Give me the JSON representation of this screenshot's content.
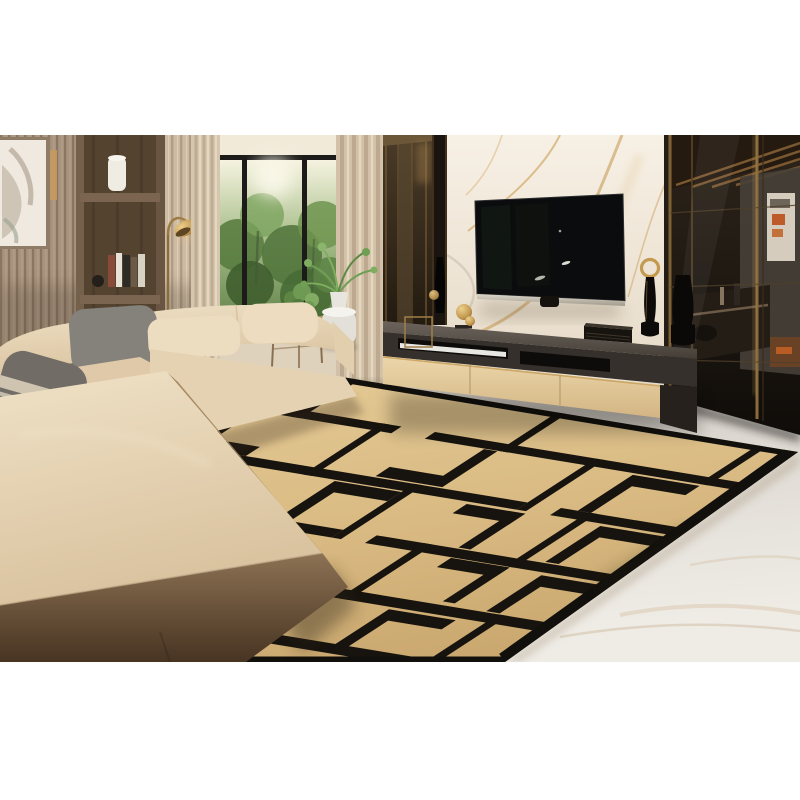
{
  "scene": {
    "type": "interior-photograph",
    "description": "Modern luxury living room: beige L-shaped sectional sofa with gray pillows, wood slat wall with lit shelving, black-framed window onto greenery, arc floor lamp, marble TV wall with wall-mounted television, long TV console with decor, smoked-glass partition, and a large tan rug with a black geometric key pattern on a light marble floor.",
    "layout": "white letterbox band above and below a full-width photo"
  },
  "palette": {
    "letterbox": "#ffffff",
    "wood_slat_wall": "#a8937d",
    "shelf_wood": "#6a5442",
    "shelf_led_glow": "#e9b96a",
    "curtain": "#d6c6ae",
    "window_frame": "#1c1b19",
    "foliage": "#6f944f",
    "marble_wall": "#f4ede2",
    "marble_vein_gold": "#c79c58",
    "tv_screen": "#0b0c0d",
    "tv_bezel_silver": "#c6c0b4",
    "console_top": "#575049",
    "console_drawer": "#e3cda2",
    "sofa_beige": "#e9d8bb",
    "sofa_shadow_brown": "#5b4631",
    "pillow_gray": "#7b776f",
    "rug_tan": "#dcbd86",
    "rug_black": "#17130e",
    "floor_marble": "#e4e0da",
    "partition_bronze": "#8a6c3c",
    "partition_room": "#1f1a16",
    "poster_accent_orange": "#bd5c2a",
    "brass_gold": "#c59b52"
  },
  "objects": [
    {
      "name": "framed-artwork",
      "label": "Abstract framed artwork on left wall"
    },
    {
      "name": "slat-wall",
      "label": "Vertical wood slat wall"
    },
    {
      "name": "built-in-shelf",
      "label": "Built-in wooden shelving with LED strips"
    },
    {
      "name": "shelf-lamp",
      "label": "White cylinder lamp on top shelf"
    },
    {
      "name": "shelf-books",
      "label": "Books on middle shelf"
    },
    {
      "name": "shelf-vases",
      "label": "Small dark vases on lower shelf"
    },
    {
      "name": "arc-floor-lamp",
      "label": "Brass arc floor lamp"
    },
    {
      "name": "window",
      "label": "Black framed window with garden view"
    },
    {
      "name": "curtains",
      "label": "Beige floor-length curtains"
    },
    {
      "name": "side-table-plant",
      "label": "Potted plant on wooden side table"
    },
    {
      "name": "white-stool-fern",
      "label": "Fern plant on white stool"
    },
    {
      "name": "bronze-cabinet",
      "label": "Tall bronze glass cabinet"
    },
    {
      "name": "marble-wall",
      "label": "White marble TV feature wall with gold veining"
    },
    {
      "name": "television",
      "label": "Wall mounted flat screen TV"
    },
    {
      "name": "tv-console",
      "label": "Long TV console with beige drawers"
    },
    {
      "name": "soundbar",
      "label": "White soundbar in console shelf"
    },
    {
      "name": "speaker",
      "label": "Black speaker on console"
    },
    {
      "name": "gold-sculpture",
      "label": "Gold decorative sculpture"
    },
    {
      "name": "candle-holder",
      "label": "Tall black candle holder with gold ring"
    },
    {
      "name": "glass-partition",
      "label": "Smoked glass partition to adjoining room"
    },
    {
      "name": "poster",
      "label": "Poster with orange accents behind glass"
    },
    {
      "name": "sectional-sofa",
      "label": "Beige L-shaped sectional sofa"
    },
    {
      "name": "pillows",
      "label": "Gray and beige throw pillows"
    },
    {
      "name": "geometric-rug",
      "label": "Tan rug with black geometric key pattern"
    },
    {
      "name": "marble-floor",
      "label": "Light marble floor"
    }
  ]
}
